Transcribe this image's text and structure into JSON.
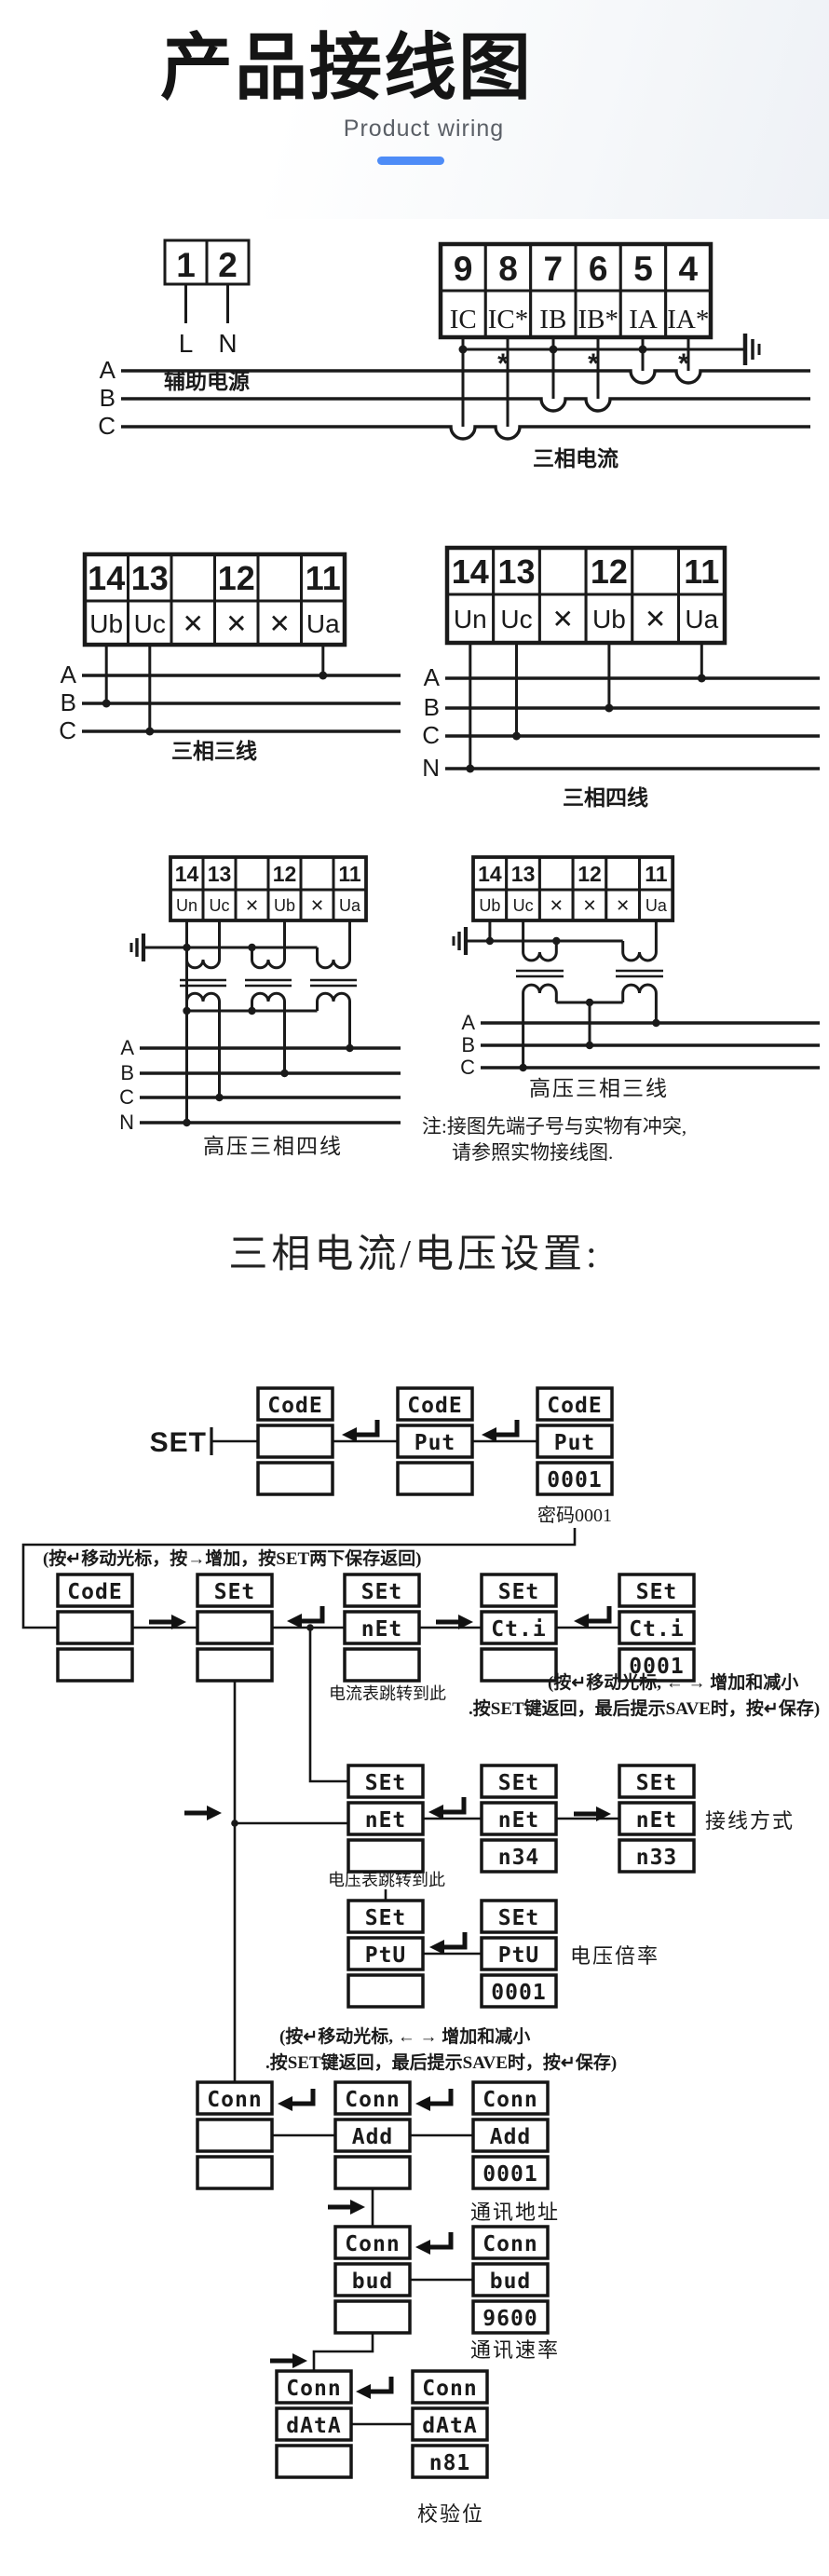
{
  "header": {
    "title": "产品接线图",
    "subtitle": "Product wiring",
    "accent_color": "#4e8cf7"
  },
  "aux_power": {
    "terminals": [
      "1",
      "2"
    ],
    "wires": [
      "L",
      "N"
    ],
    "caption": "辅助电源"
  },
  "phase_current": {
    "numbers": [
      "9",
      "8",
      "7",
      "6",
      "5",
      "4"
    ],
    "labels": [
      "IC",
      "IC*",
      "IB",
      "IB*",
      "IA",
      "IA*"
    ],
    "phases": [
      "A",
      "B",
      "C"
    ],
    "polarity_mark": "*",
    "caption": "三相电流"
  },
  "three_wire": {
    "numbers": [
      "14",
      "13",
      "",
      "12",
      "",
      "11"
    ],
    "labels": [
      "Ub",
      "Uc",
      "✕",
      "✕",
      "✕",
      "Ua"
    ],
    "phases": [
      "A",
      "B",
      "C"
    ],
    "caption": "三相三线"
  },
  "four_wire": {
    "numbers": [
      "14",
      "13",
      "",
      "12",
      "",
      "11"
    ],
    "labels": [
      "Un",
      "Uc",
      "✕",
      "Ub",
      "✕",
      "Ua"
    ],
    "phases": [
      "A",
      "B",
      "C",
      "N"
    ],
    "caption": "三相四线"
  },
  "hv_four_wire": {
    "numbers": [
      "14",
      "13",
      "",
      "12",
      "",
      "11"
    ],
    "labels": [
      "Un",
      "Uc",
      "✕",
      "Ub",
      "✕",
      "Ua"
    ],
    "phases": [
      "A",
      "B",
      "C",
      "N"
    ],
    "caption": "高压三相四线"
  },
  "hv_three_wire": {
    "numbers": [
      "14",
      "13",
      "",
      "12",
      "",
      "11"
    ],
    "labels": [
      "Ub",
      "Uc",
      "✕",
      "✕",
      "✕",
      "Ua"
    ],
    "phases": [
      "A",
      "B",
      "C"
    ],
    "caption": "高压三相三线"
  },
  "note": {
    "line1": "注:接图先端子号与实物有冲突,",
    "line2": "请参照实物接线图."
  },
  "settings": {
    "title": "三相电流/电压设置:"
  },
  "flowchart": {
    "set_label": "SET",
    "hint_top": "(按↵移动光标，按→增加，按SET两下保存返回)",
    "hint_a1": "(按↵移动光标, ←  → 增加和减小",
    "hint_a2": ".按SET键返回，最后提示SAVE时，按↵保存)",
    "hint_b1": "(按↵移动光标, ←  → 增加和减小",
    "hint_b2": ".按SET键返回，最后提示SAVE时，按↵保存)",
    "captions": {
      "password": "密码0001",
      "ammeter": "电流表跳转到此",
      "voltmeter": "电压表跳转到此",
      "wiring_mode": "接线方式",
      "voltage_ratio": "电压倍率",
      "comm_address": "通讯地址",
      "comm_baud": "通讯速率",
      "parity": "校验位"
    },
    "stacks": {
      "r1s1": [
        "CodE",
        "",
        ""
      ],
      "r1s2": [
        "CodE",
        "Put",
        ""
      ],
      "r1s3": [
        "CodE",
        "Put",
        "0001"
      ],
      "r2s1": [
        "CodE",
        "",
        ""
      ],
      "r2s2": [
        "SEt",
        "",
        ""
      ],
      "r2s3": [
        "SEt",
        "nEt",
        ""
      ],
      "r2s4": [
        "SEt",
        "Ct.i",
        ""
      ],
      "r2s5": [
        "SEt",
        "Ct.i",
        "0001"
      ],
      "r3s1": [
        "SEt",
        "nEt",
        ""
      ],
      "r3s2": [
        "SEt",
        "nEt",
        "n34"
      ],
      "r3s3": [
        "SEt",
        "nEt",
        "n33"
      ],
      "r4s1": [
        "SEt",
        "PtU",
        ""
      ],
      "r4s2": [
        "SEt",
        "PtU",
        "0001"
      ],
      "r5s1": [
        "Conn",
        "",
        ""
      ],
      "r5s2": [
        "Conn",
        "Add",
        ""
      ],
      "r5s3": [
        "Conn",
        "Add",
        "0001"
      ],
      "r6s1": [
        "Conn",
        "bud",
        ""
      ],
      "r6s2": [
        "Conn",
        "bud",
        "9600"
      ],
      "r7s1": [
        "Conn",
        "dAtA",
        ""
      ],
      "r7s2": [
        "Conn",
        "dAtA",
        "n81"
      ]
    }
  }
}
